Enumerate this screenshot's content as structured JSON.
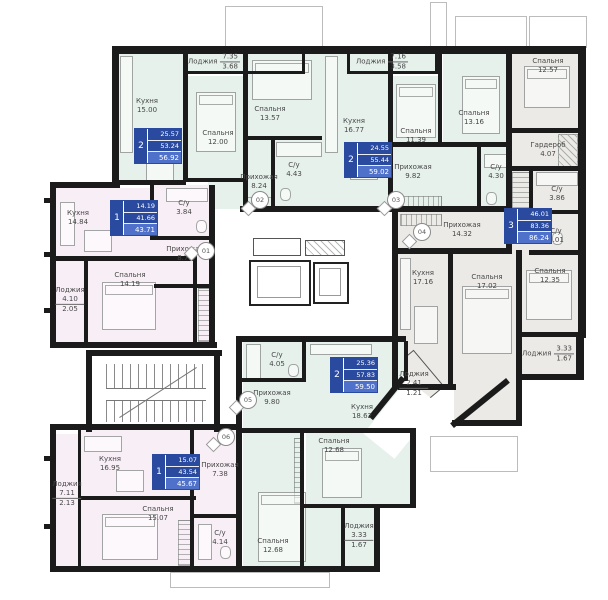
{
  "apartments": {
    "a01": {
      "rooms_count": "1",
      "living": "14.19",
      "area": "41.66",
      "total": "43.71",
      "labels": {
        "kitchen": {
          "name": "Кухня",
          "value": "14.84"
        },
        "bath": {
          "name": "С/у",
          "value": "3.84"
        },
        "hall": {
          "name": "Прихожая",
          "value": "8.79"
        },
        "bedroom": {
          "name": "Спальня",
          "value": "14.19"
        },
        "loggia": {
          "name": "Лоджия",
          "top": "4.10",
          "bottom": "2.05"
        }
      }
    },
    "a02": {
      "rooms_count": "2",
      "living": "25.57",
      "area": "53.24",
      "total": "56.92",
      "labels": {
        "loggia": {
          "name": "Лоджия",
          "top": "7.35",
          "bottom": "3.68"
        },
        "kitchen": {
          "name": "Кухня",
          "value": "15.00"
        },
        "bedroom1": {
          "name": "Спальня",
          "value": "12.00"
        },
        "bedroom2": {
          "name": "Спальня",
          "value": "13.57"
        },
        "hall": {
          "name": "Прихожая",
          "value": "8.24"
        },
        "bath": {
          "name": "С/у",
          "value": "4.43"
        }
      }
    },
    "a03": {
      "rooms_count": "2",
      "living": "24.55",
      "area": "55.44",
      "total": "59.02",
      "labels": {
        "loggia": {
          "name": "Лоджия",
          "top": "7.16",
          "bottom": "3.58"
        },
        "kitchen": {
          "name": "Кухня",
          "value": "16.77"
        },
        "bedroom1": {
          "name": "Спальня",
          "value": "11.39"
        },
        "bedroom2": {
          "name": "Спальня",
          "value": "13.16"
        },
        "hall": {
          "name": "Прихожая",
          "value": "9.82"
        },
        "bath": {
          "name": "С/у",
          "value": "4.30"
        }
      }
    },
    "a04": {
      "rooms_count": "3",
      "living": "46.01",
      "area": "83.36",
      "total": "86.24",
      "labels": {
        "bedroom1": {
          "name": "Спальня",
          "value": "12.57"
        },
        "wardrobe": {
          "name": "Гардероб",
          "value": "4.07"
        },
        "bath1": {
          "name": "С/у",
          "value": "3.86"
        },
        "bath2": {
          "name": "С/у",
          "value": "2.01"
        },
        "hall": {
          "name": "Прихожая",
          "value": "14.32"
        },
        "kitchen": {
          "name": "Кухня",
          "value": "17.16"
        },
        "bedroom2": {
          "name": "Спальня",
          "value": "17.02"
        },
        "bedroom3": {
          "name": "Спальня",
          "value": "12.35"
        },
        "loggia1": {
          "name": "Лоджия",
          "top": "3.33",
          "bottom": "1.67"
        },
        "loggia2": {
          "name": "Лоджия",
          "top": "2.41",
          "bottom": "1.21"
        }
      }
    },
    "a05": {
      "rooms_count": "2",
      "living": "25.36",
      "area": "57.83",
      "total": "59.50",
      "labels": {
        "bath": {
          "name": "С/у",
          "value": "4.05"
        },
        "hall": {
          "name": "Прихожая",
          "value": "9.80"
        },
        "kitchen": {
          "name": "Кухня",
          "value": "18.62"
        },
        "bedroom1": {
          "name": "Спальня",
          "value": "12.68"
        },
        "bedroom2": {
          "name": "Спальня",
          "value": "12.68"
        },
        "loggia": {
          "name": "Лоджия",
          "top": "3.33",
          "bottom": "1.67"
        }
      }
    },
    "a06": {
      "rooms_count": "1",
      "living": "15.07",
      "area": "43.54",
      "total": "45.67",
      "labels": {
        "kitchen": {
          "name": "Кухня",
          "value": "16.95"
        },
        "loggia": {
          "name": "Лоджия",
          "top": "7.11",
          "bottom": "2.13"
        },
        "hall": {
          "name": "Прихожая",
          "value": "7.38"
        },
        "bedroom": {
          "name": "Спальня",
          "value": "15.07"
        },
        "bath": {
          "name": "С/у",
          "value": "4.14"
        }
      }
    }
  },
  "markers": {
    "m01": "01",
    "m02": "02",
    "m03": "03",
    "m04": "04",
    "m05": "05",
    "m06": "06"
  }
}
